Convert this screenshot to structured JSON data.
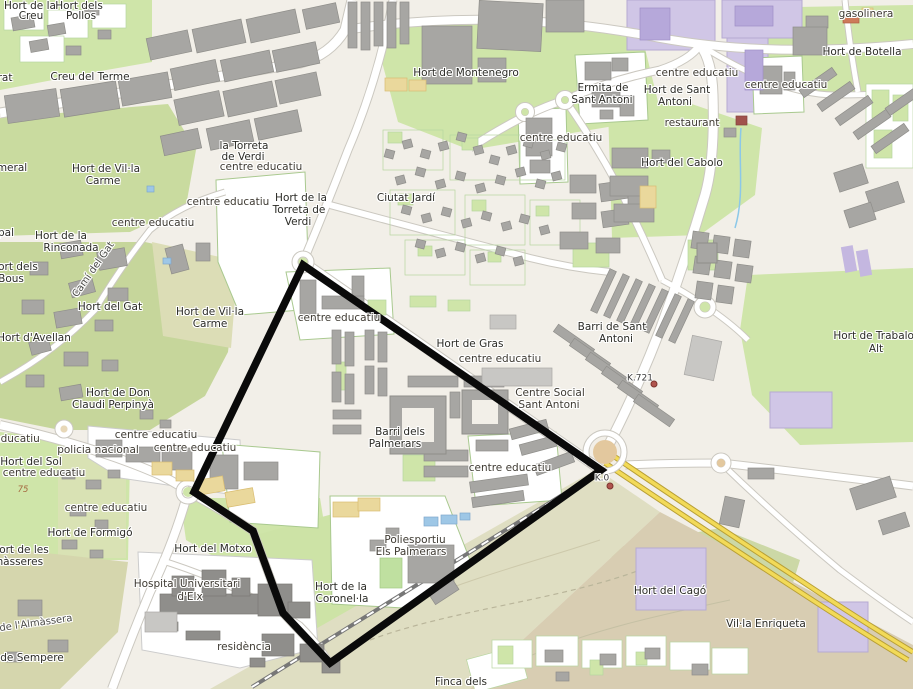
{
  "map": {
    "description": "Street map of eastern Elx (Elche) with a black district boundary around Barri dels Palmerars",
    "boundary": {
      "points": "303,265 601,470 330,663 283,613 253,531 194,492",
      "color": "#0a0a0a",
      "width": 7.5
    },
    "colors": {
      "background": "#f2efe8",
      "grass": "#cfe5a9",
      "scrub": "#dfdec2",
      "building": "#a7a6a3",
      "lavender_zone": "#d0c6e6",
      "motorway_yellow": "#f2da58",
      "roundabout_tan": "#e3c89e",
      "milestone_dot": "#b0544e",
      "water": "#9ec7e6"
    },
    "labels": [
      {
        "t": "Hort de la",
        "x": 30,
        "y": 6,
        "k": "place"
      },
      {
        "t": "Creu",
        "x": 31,
        "y": 16,
        "k": "place"
      },
      {
        "t": "Hort dels",
        "x": 79,
        "y": 6,
        "k": "place"
      },
      {
        "t": "Pollos",
        "x": 81,
        "y": 16,
        "k": "place"
      },
      {
        "t": "Creu del Terme",
        "x": 90,
        "y": 77,
        "k": "place"
      },
      {
        "t": "rat",
        "x": 5,
        "y": 78,
        "k": "place"
      },
      {
        "t": "meral",
        "x": 12,
        "y": 168,
        "k": "place"
      },
      {
        "t": "Hort de Vil·la",
        "x": 106,
        "y": 169,
        "k": "place"
      },
      {
        "t": "Carme",
        "x": 103,
        "y": 181,
        "k": "place"
      },
      {
        "t": "la Torreta",
        "x": 244,
        "y": 146,
        "k": "place"
      },
      {
        "t": "de Verdi",
        "x": 243,
        "y": 157,
        "k": "place"
      },
      {
        "t": "centre educatiu",
        "x": 261,
        "y": 167,
        "k": "amenity"
      },
      {
        "t": "centre educatiu",
        "x": 228,
        "y": 202,
        "k": "amenity"
      },
      {
        "t": "centre educatiu",
        "x": 153,
        "y": 223,
        "k": "amenity"
      },
      {
        "t": "Hort de la",
        "x": 301,
        "y": 198,
        "k": "place"
      },
      {
        "t": "Torreta de",
        "x": 299,
        "y": 210,
        "k": "place"
      },
      {
        "t": "Verdi",
        "x": 298,
        "y": 222,
        "k": "place"
      },
      {
        "t": "Ciutat Jardí",
        "x": 406,
        "y": 198,
        "k": "place"
      },
      {
        "t": "Hort de Montenegro",
        "x": 466,
        "y": 73,
        "k": "place"
      },
      {
        "t": "Ermita de",
        "x": 603,
        "y": 88,
        "k": "place"
      },
      {
        "t": "Sant Antoni",
        "x": 602,
        "y": 100,
        "k": "place"
      },
      {
        "t": "centre educatiu",
        "x": 697,
        "y": 73,
        "k": "amenity"
      },
      {
        "t": "Hort de Sant",
        "x": 677,
        "y": 90,
        "k": "place"
      },
      {
        "t": "Antoni",
        "x": 675,
        "y": 102,
        "k": "place"
      },
      {
        "t": "centre educatiu",
        "x": 786,
        "y": 85,
        "k": "amenity"
      },
      {
        "t": "centre educatiu",
        "x": 561,
        "y": 138,
        "k": "amenity"
      },
      {
        "t": "gasolinera",
        "x": 866,
        "y": 14,
        "k": "amenity"
      },
      {
        "t": "Hort de Botella",
        "x": 862,
        "y": 52,
        "k": "place"
      },
      {
        "t": "restaurant",
        "x": 692,
        "y": 123,
        "k": "amenity"
      },
      {
        "t": "Hort del Cabolo",
        "x": 682,
        "y": 163,
        "k": "place"
      },
      {
        "t": "pal",
        "x": 6,
        "y": 233,
        "k": "place"
      },
      {
        "t": "Hort de la",
        "x": 61,
        "y": 236,
        "k": "place"
      },
      {
        "t": "Rinconada",
        "x": 71,
        "y": 248,
        "k": "place"
      },
      {
        "t": "Hort dels",
        "x": 14,
        "y": 267,
        "k": "place"
      },
      {
        "t": "Bous",
        "x": 11,
        "y": 279,
        "k": "place"
      },
      {
        "t": "Hort del Gat",
        "x": 110,
        "y": 307,
        "k": "place"
      },
      {
        "t": "Hort de Vil·la",
        "x": 210,
        "y": 312,
        "k": "place"
      },
      {
        "t": "Carme",
        "x": 210,
        "y": 324,
        "k": "place"
      },
      {
        "t": "Hort d'Avellan",
        "x": 34,
        "y": 338,
        "k": "place"
      },
      {
        "t": "Barri de Sant",
        "x": 612,
        "y": 327,
        "k": "place"
      },
      {
        "t": "Antoni",
        "x": 616,
        "y": 339,
        "k": "place"
      },
      {
        "t": "Hort de Trabalon",
        "x": 877,
        "y": 336,
        "k": "place"
      },
      {
        "t": "Alt",
        "x": 876,
        "y": 349,
        "k": "place"
      },
      {
        "t": "Hort de Gras",
        "x": 470,
        "y": 344,
        "k": "place"
      },
      {
        "t": "centre educatiu",
        "x": 339,
        "y": 318,
        "k": "amenity"
      },
      {
        "t": "centre educatiu",
        "x": 500,
        "y": 359,
        "k": "amenity"
      },
      {
        "t": "Centre Social",
        "x": 550,
        "y": 393,
        "k": "amenity"
      },
      {
        "t": "Sant Antoni",
        "x": 549,
        "y": 405,
        "k": "amenity"
      },
      {
        "t": "Hort de Don",
        "x": 118,
        "y": 393,
        "k": "place"
      },
      {
        "t": "Claudi Perpinyà",
        "x": 113,
        "y": 405,
        "k": "place"
      },
      {
        "t": "Barri dels",
        "x": 400,
        "y": 432,
        "k": "place"
      },
      {
        "t": "Palmerars",
        "x": 395,
        "y": 444,
        "k": "place"
      },
      {
        "t": "centre educatiu",
        "x": 510,
        "y": 468,
        "k": "amenity"
      },
      {
        "t": "educatiu",
        "x": 17,
        "y": 439,
        "k": "amenity"
      },
      {
        "t": "centre educatiu",
        "x": 156,
        "y": 435,
        "k": "amenity"
      },
      {
        "t": "centre educatiu",
        "x": 195,
        "y": 448,
        "k": "amenity"
      },
      {
        "t": "policia nacional",
        "x": 98,
        "y": 450,
        "k": "amenity"
      },
      {
        "t": "Hort del Sol",
        "x": 31,
        "y": 462,
        "k": "place"
      },
      {
        "t": "centre educatiu",
        "x": 44,
        "y": 473,
        "k": "amenity"
      },
      {
        "t": "centre educatiu",
        "x": 106,
        "y": 508,
        "k": "amenity"
      },
      {
        "t": "Hort de Formigó",
        "x": 90,
        "y": 533,
        "k": "place"
      },
      {
        "t": "Hort de les",
        "x": 20,
        "y": 550,
        "k": "place"
      },
      {
        "t": "màsseres",
        "x": 18,
        "y": 562,
        "k": "place"
      },
      {
        "t": "Hort del Motxo",
        "x": 213,
        "y": 549,
        "k": "place"
      },
      {
        "t": "Hospital Universitari",
        "x": 187,
        "y": 584,
        "k": "amenity"
      },
      {
        "t": "d'Elx",
        "x": 190,
        "y": 597,
        "k": "amenity"
      },
      {
        "t": "residència",
        "x": 244,
        "y": 647,
        "k": "amenity"
      },
      {
        "t": "Poliesportiu",
        "x": 415,
        "y": 540,
        "k": "amenity"
      },
      {
        "t": "Els Palmerars",
        "x": 411,
        "y": 552,
        "k": "amenity"
      },
      {
        "t": "Hort de la",
        "x": 341,
        "y": 587,
        "k": "place"
      },
      {
        "t": "Coronel·la",
        "x": 342,
        "y": 599,
        "k": "place"
      },
      {
        "t": "Hort del Cagó",
        "x": 670,
        "y": 591,
        "k": "place"
      },
      {
        "t": "Vil·la Enriqueta",
        "x": 766,
        "y": 624,
        "k": "place"
      },
      {
        "t": "de Sempere",
        "x": 32,
        "y": 658,
        "k": "place"
      },
      {
        "t": "Finca dels",
        "x": 461,
        "y": 682,
        "k": "place"
      },
      {
        "t": "Camí del Gat",
        "x": 94,
        "y": 270,
        "k": "road",
        "r": -55
      },
      {
        "t": "de l'Almàssera",
        "x": 36,
        "y": 624,
        "k": "road",
        "r": -8
      }
    ],
    "milestones": [
      {
        "label": "K.0",
        "x": 602,
        "y": 479,
        "dot_x": 610,
        "dot_y": 486
      },
      {
        "label": "K.721",
        "x": 640,
        "y": 379,
        "dot_x": 654,
        "dot_y": 384
      }
    ],
    "contour_labels": [
      {
        "label": "75",
        "x": 23,
        "y": 490
      }
    ]
  }
}
